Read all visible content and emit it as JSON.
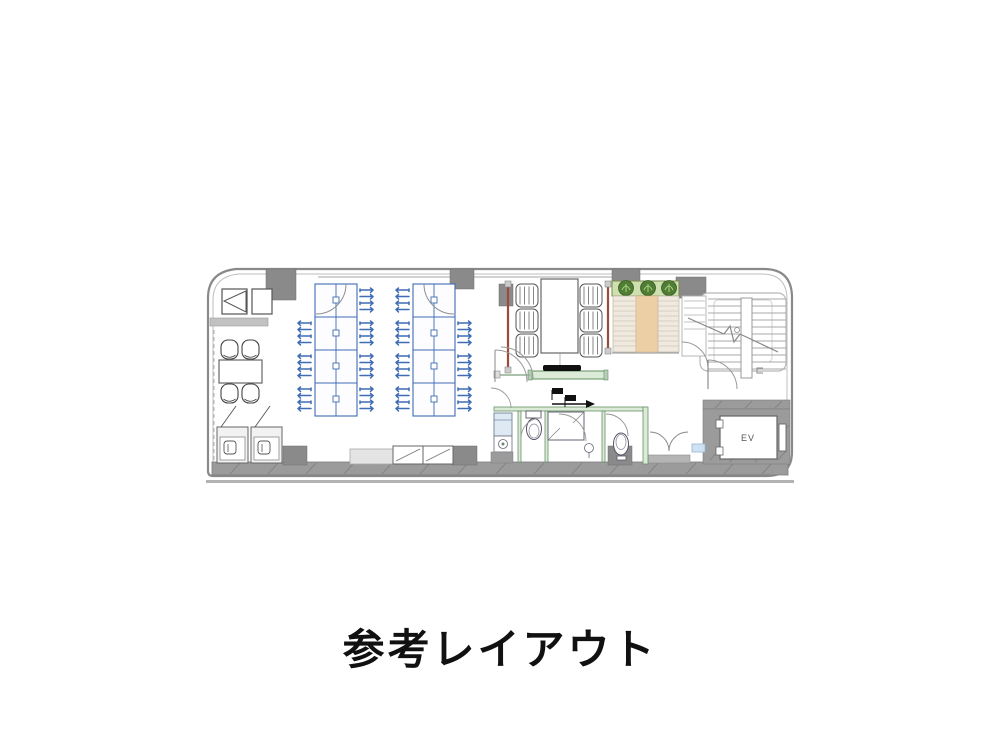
{
  "title": {
    "caption": "参考レイアウト"
  },
  "floor_plan": {
    "labels": {
      "elevator": "EV"
    },
    "colors": {
      "wall_gray": "#9b9b9b",
      "wall_dark": "#8a8a8a",
      "desk_blue": "#3f6cb4",
      "meeting_wall_red": "#9c4b3b",
      "partition_green": "#679267",
      "partition_green_fill": "#dcead8",
      "bench_tan": "#eccfa5",
      "bench_stripe": "#efe9df",
      "planter_fill": "#cfe0b0",
      "plant_green": "#4e7d33",
      "sink_blue": "#dfe9f4",
      "tv_black": "#111111",
      "line_gray": "#9f9f9f"
    },
    "areas": [
      {
        "name": "entrance-lobby"
      },
      {
        "name": "meeting-nook"
      },
      {
        "name": "phone-booths"
      },
      {
        "name": "open-office"
      },
      {
        "name": "meeting-room"
      },
      {
        "name": "bench-lounge"
      },
      {
        "name": "restrooms"
      },
      {
        "name": "stairwell"
      },
      {
        "name": "elevator"
      }
    ]
  }
}
